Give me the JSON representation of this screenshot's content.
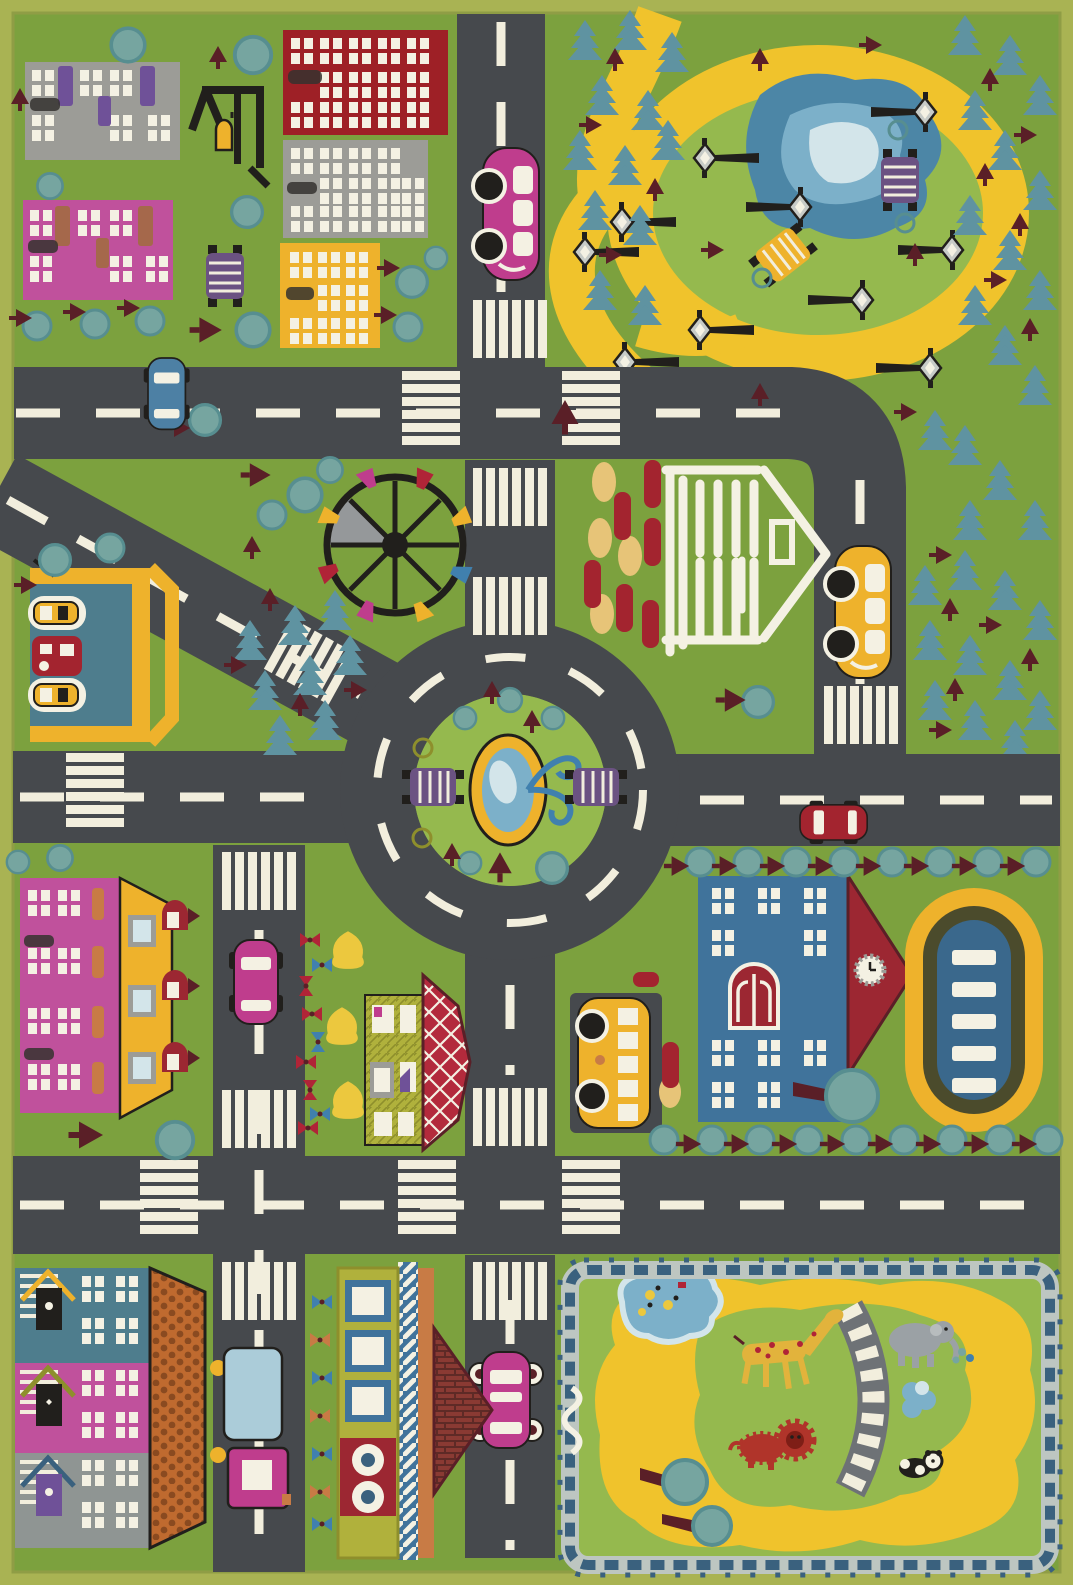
{
  "image_type": "photograph of a children's city road-map play rug (top-down toy town)",
  "palette": {
    "border": "#a9b353",
    "borderline": "#8f9d45",
    "grass": "#7ca13e",
    "park": "#95b94e",
    "road": "#46494d",
    "marking": "#f2eedd",
    "path": "#f0c32c",
    "pondd": "#4c86a6",
    "pondm": "#7cb0c9",
    "pondl": "#d3e5ea",
    "tree": "#76a5a0",
    "treedark": "#578e90",
    "pine": "#5f93a1",
    "maroon": "#5a1f27",
    "redb": "#9e2026",
    "grayb": "#9c9c97",
    "white": "#f4f1e3",
    "purple": "#6f5198",
    "pinkb": "#c0519c",
    "brown": "#a5684b",
    "yellow": "#eeb22c",
    "paleyellow": "#e7c478",
    "magcar": "#bf3d8d",
    "bluecar": "#4d80a4",
    "redcar": "#a3242f",
    "schoolb": "#40739b",
    "schoolr": "#9c2732",
    "stadb": "#3a688c",
    "trackd": "#4b4b2c",
    "cab": "#abccd9",
    "oroof": "#bf6a2f",
    "oroofd": "#8a4a20",
    "brick": "#8a3a33",
    "brickline": "#5e2a26",
    "diam": "#b32a3c",
    "olive": "#b0b13c",
    "oliveline": "#8e8f2c",
    "tealh": "#4e7d8d",
    "grayh": "#8f9593",
    "fencel": "#bdc6c1",
    "fenceb": "#3a617e",
    "gir": "#e2b33c",
    "ele": "#9ba1a5",
    "lion": "#b0342a",
    "lampg": "#c7cbc7",
    "benchp": "#6b5282",
    "flr": "#b02437",
    "flb": "#4080ae",
    "flo": "#c87b45",
    "bushy": "#ecc83e",
    "ink": "#211f1c",
    "smudge": "#35332f"
  },
  "scene": {
    "districts": {
      "top_left_block": {
        "buildings": [
          "gray-apartment",
          "pink-apartment"
        ],
        "furniture": [
          "playground-swing-frame",
          "purple-bench"
        ],
        "trees": "round teal trees and maroon saplings"
      },
      "top_middle_block": {
        "buildings": [
          "red-apartment",
          "gray-apartment",
          "yellow-house"
        ]
      },
      "park_top_right": {
        "features": [
          "yellow-walking-path-loop",
          "pond",
          "street-lamps",
          "purple-bench",
          "yellow-bench",
          "pine-forest",
          "round-bushes"
        ],
        "street_lamp_count": 10
      },
      "city_center": {
        "features": [
          "ferris-wheel",
          "museum-with-columns",
          "parking-red-cars",
          "roundabout-with-fountain",
          "island-benches"
        ]
      },
      "west_block": {
        "features": [
          "parking-garage",
          "pink-yellow-roof-house",
          "flower-garden",
          "red-diamond-roof-house"
        ]
      },
      "east_block": {
        "features": [
          "school-with-clock-roof",
          "school-bus",
          "stadium-pool",
          "tree-rows"
        ]
      },
      "bottom_left_block": {
        "features": [
          "three-row-houses-orange-shingle-roof",
          "truck",
          "flower-strip",
          "olive-apartment-brick-roof"
        ]
      },
      "zoo_bottom_right": {
        "animals": [
          "giraffe",
          "elephant",
          "lion",
          "panda"
        ],
        "features": [
          "picket-fence",
          "yellow-path",
          "pond-with-flowers",
          "footbridge",
          "trees"
        ]
      }
    },
    "vehicles": [
      {
        "type": "car-side-view",
        "color_key": "magcar",
        "location": "top-vertical-road"
      },
      {
        "type": "car-top-view",
        "color_key": "bluecar",
        "location": "top-horizontal-road"
      },
      {
        "type": "car-side-view",
        "color_key": "yellow",
        "location": "museum-road"
      },
      {
        "type": "car-top-view",
        "color_key": "redcar",
        "location": "east-road"
      },
      {
        "type": "car-top-view",
        "color_key": "magcar",
        "location": "west-vertical-road"
      },
      {
        "type": "car-top-view",
        "color_key": "magcar",
        "location": "south-road"
      },
      {
        "type": "bus",
        "color_key": "yellow",
        "location": "school-parking-pad"
      },
      {
        "type": "truck",
        "color_key": "cab",
        "location": "bottom-left-road"
      },
      {
        "type": "parked-cars",
        "color_key": "redcar",
        "location": "museum-parking",
        "count": 6
      },
      {
        "type": "parked-cars",
        "color_key": "yellow",
        "location": "garage-bays",
        "count": 2
      },
      {
        "type": "parked-car",
        "color_key": "redcar",
        "location": "garage-bays",
        "count": 1
      }
    ],
    "road_features": [
      "white-dashed-centerlines",
      "zebra-crosswalks",
      "roundabout-ring-dashes"
    ]
  }
}
